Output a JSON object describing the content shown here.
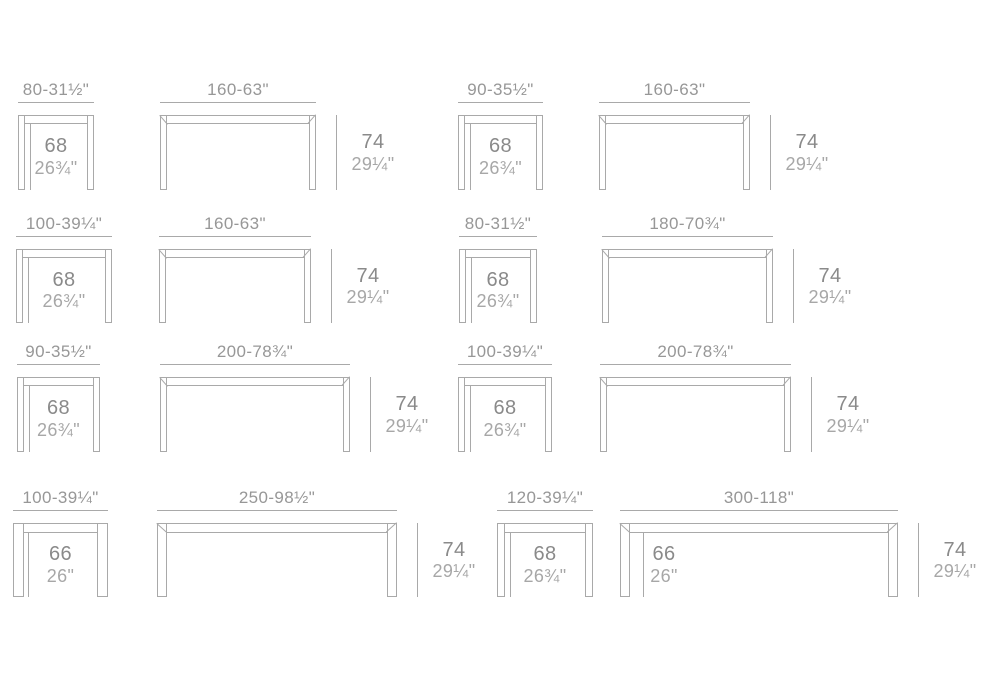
{
  "style": {
    "background": "#ffffff",
    "line_color": "#a9a9a9",
    "width_label_color": "#979797",
    "cm_value_color": "#8a8a8a",
    "inch_value_color": "#a7a7a7"
  },
  "diagram": {
    "description": "table-dimension-spec-sheet",
    "rows": 4,
    "columns": 4
  },
  "figures": [
    {
      "name": "table-80-row1",
      "variant": "small",
      "width_label": "80-31½\"",
      "x": 18,
      "y": 115,
      "w": 76,
      "h": 75,
      "leg": 7,
      "bar": 8,
      "inside": {
        "cm": "68",
        "in": "26¾\"",
        "ref": 12
      }
    },
    {
      "name": "table-160-row1-a",
      "variant": "large",
      "width_label": "160-63\"",
      "x": 160,
      "y": 115,
      "w": 156,
      "h": 75,
      "leg": 7,
      "bar": 8,
      "right": {
        "cm": "74",
        "in": "29¼\""
      }
    },
    {
      "name": "table-90-row1",
      "variant": "small",
      "width_label": "90-35½\"",
      "x": 458,
      "y": 115,
      "w": 85,
      "h": 75,
      "leg": 7,
      "bar": 8,
      "inside": {
        "cm": "68",
        "in": "26¾\"",
        "ref": 12
      }
    },
    {
      "name": "table-160-row1-b",
      "variant": "large",
      "width_label": "160-63\"",
      "x": 599,
      "y": 115,
      "w": 151,
      "h": 75,
      "leg": 7,
      "bar": 8,
      "right": {
        "cm": "74",
        "in": "29¼\""
      }
    },
    {
      "name": "table-100-row2",
      "variant": "small",
      "width_label": "100-39¼\"",
      "x": 16,
      "y": 249,
      "w": 96,
      "h": 74,
      "leg": 7,
      "bar": 8,
      "inside": {
        "cm": "68",
        "in": "26¾\"",
        "ref": 12
      }
    },
    {
      "name": "table-160-row2",
      "variant": "large",
      "width_label": "160-63\"",
      "x": 159,
      "y": 249,
      "w": 152,
      "h": 74,
      "leg": 7,
      "bar": 8,
      "right": {
        "cm": "74",
        "in": "29¼\""
      }
    },
    {
      "name": "table-80-row2",
      "variant": "small",
      "width_label": "80-31½\"",
      "x": 459,
      "y": 249,
      "w": 78,
      "h": 74,
      "leg": 7,
      "bar": 8,
      "inside": {
        "cm": "68",
        "in": "26¾\"",
        "ref": 12
      }
    },
    {
      "name": "table-180-row2",
      "variant": "large",
      "width_label": "180-70¾\"",
      "x": 602,
      "y": 249,
      "w": 171,
      "h": 74,
      "leg": 7,
      "bar": 8,
      "right": {
        "cm": "74",
        "in": "29¼\""
      }
    },
    {
      "name": "table-90-row3",
      "variant": "small",
      "width_label": "90-35½\"",
      "x": 17,
      "y": 377,
      "w": 83,
      "h": 75,
      "leg": 7,
      "bar": 8,
      "inside": {
        "cm": "68",
        "in": "26¾\"",
        "ref": 12
      }
    },
    {
      "name": "table-200-row3-a",
      "variant": "large",
      "width_label": "200-78¾\"",
      "x": 160,
      "y": 377,
      "w": 190,
      "h": 75,
      "leg": 7,
      "bar": 8,
      "right": {
        "cm": "74",
        "in": "29¼\""
      }
    },
    {
      "name": "table-100-row3",
      "variant": "small",
      "width_label": "100-39¼\"",
      "x": 458,
      "y": 377,
      "w": 94,
      "h": 75,
      "leg": 7,
      "bar": 8,
      "inside": {
        "cm": "68",
        "in": "26¾\"",
        "ref": 12
      }
    },
    {
      "name": "table-200-row3-b",
      "variant": "large",
      "width_label": "200-78¾\"",
      "x": 600,
      "y": 377,
      "w": 191,
      "h": 75,
      "leg": 7,
      "bar": 8,
      "right": {
        "cm": "74",
        "in": "29¼\""
      }
    },
    {
      "name": "table-100-row4",
      "variant": "small",
      "width_label": "100-39¼\"",
      "x": 13,
      "y": 523,
      "w": 95,
      "h": 74,
      "leg": 11,
      "bar": 9,
      "inside": {
        "cm": "66",
        "in": "26\"",
        "ref": 15
      }
    },
    {
      "name": "table-250-row4",
      "variant": "large",
      "width_label": "250-98½\"",
      "x": 157,
      "y": 523,
      "w": 240,
      "h": 74,
      "leg": 10,
      "bar": 9,
      "right": {
        "cm": "74",
        "in": "29¼\""
      }
    },
    {
      "name": "table-120-row4",
      "variant": "small",
      "width_label": "120-39¼\"",
      "x": 497,
      "y": 523,
      "w": 96,
      "h": 74,
      "leg": 8,
      "bar": 9,
      "inside": {
        "cm": "68",
        "in": "26¾\"",
        "ref": 13
      }
    },
    {
      "name": "table-300-row4",
      "variant": "large",
      "width_label": "300-118\"",
      "x": 620,
      "y": 523,
      "w": 278,
      "h": 74,
      "leg": 10,
      "bar": 9,
      "inside": {
        "cm": "66",
        "in": "26\"",
        "ref": 23,
        "center": 44
      },
      "right": {
        "cm": "74",
        "in": "29¼\""
      }
    }
  ]
}
